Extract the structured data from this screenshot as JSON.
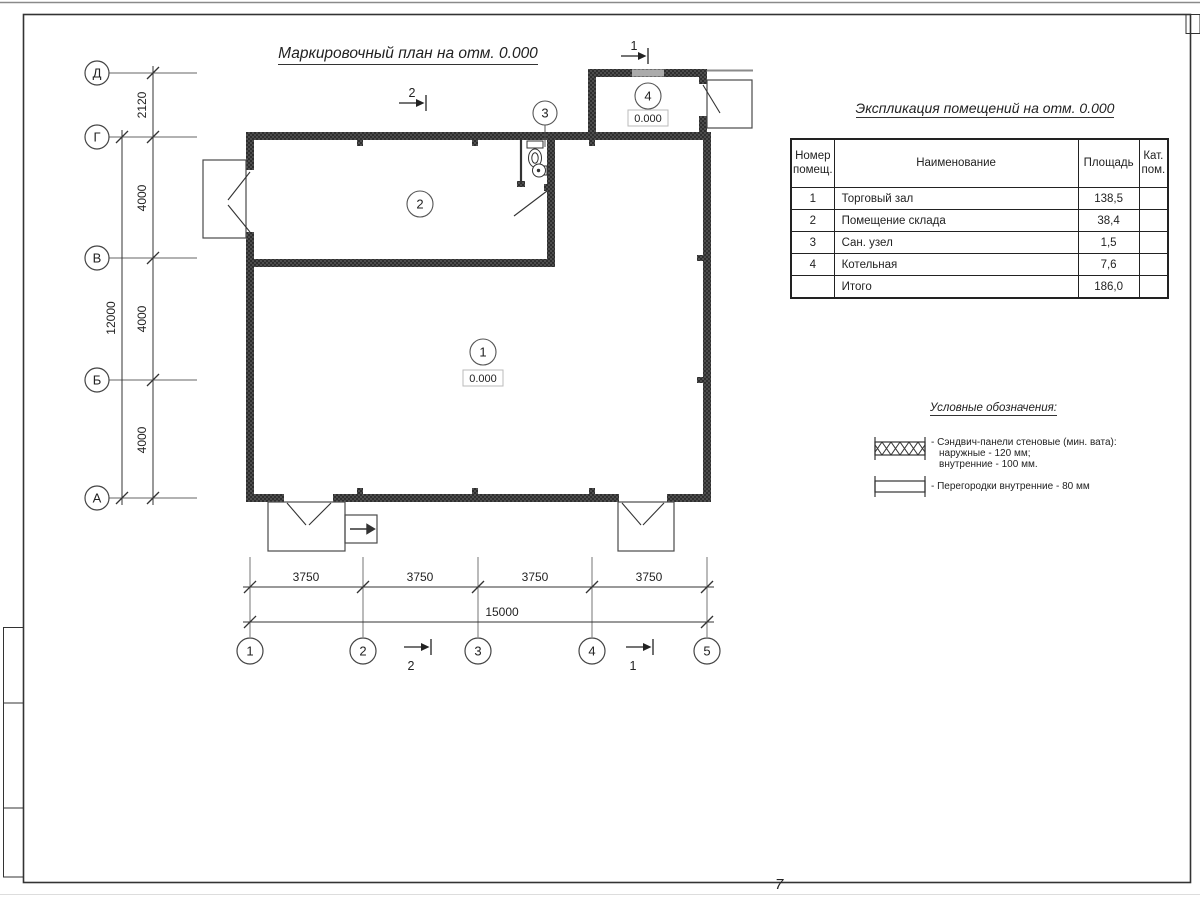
{
  "sheet": {
    "page_number": "7"
  },
  "colors": {
    "ink": "#222222",
    "wall_fill": "#2e2e2e",
    "window_gray": "#ababab"
  },
  "drawing": {
    "plan_title": "Маркировочный план на отм. 0.000",
    "axes": {
      "rows": [
        "Д",
        "Г",
        "В",
        "Б",
        "А"
      ],
      "cols": [
        "1",
        "2",
        "3",
        "4",
        "5"
      ]
    },
    "dimensions": {
      "left_segments": [
        "2120",
        "4000",
        "4000",
        "4000"
      ],
      "left_total": "12000",
      "bottom_segments": [
        "3750",
        "3750",
        "3750",
        "3750"
      ],
      "bottom_total": "15000"
    },
    "rooms": [
      {
        "number": "1",
        "elevation": "0.000"
      },
      {
        "number": "2"
      },
      {
        "number": "3"
      },
      {
        "number": "4",
        "elevation": "0.000"
      }
    ],
    "section_marks": {
      "cut1": "1",
      "cut2": "2"
    }
  },
  "table": {
    "title": "Экспликация помещений на отм. 0.000",
    "col_number_l1": "Номер",
    "col_number_l2": "помещ.",
    "col_name": "Наименование",
    "col_area": "Площадь",
    "col_cat_l1": "Кат.",
    "col_cat_l2": "пом.",
    "rows": [
      {
        "num": "1",
        "name": "Торговый зал",
        "area": "138,5",
        "cat": ""
      },
      {
        "num": "2",
        "name": "Помещение склада",
        "area": "38,4",
        "cat": ""
      },
      {
        "num": "3",
        "name": "Сан. узел",
        "area": "1,5",
        "cat": ""
      },
      {
        "num": "4",
        "name": "Котельная",
        "area": "7,6",
        "cat": ""
      },
      {
        "num": "",
        "name": "Итого",
        "area": "186,0",
        "cat": ""
      }
    ]
  },
  "legend": {
    "title": "Условные обозначения:",
    "item1_line1": "- Сэндвич-панели стеновые (мин. вата):",
    "item1_line2": "наружные - 120 мм;",
    "item1_line3": "внутренние - 100 мм.",
    "item2_line1": "- Перегородки внутренние - 80 мм"
  }
}
